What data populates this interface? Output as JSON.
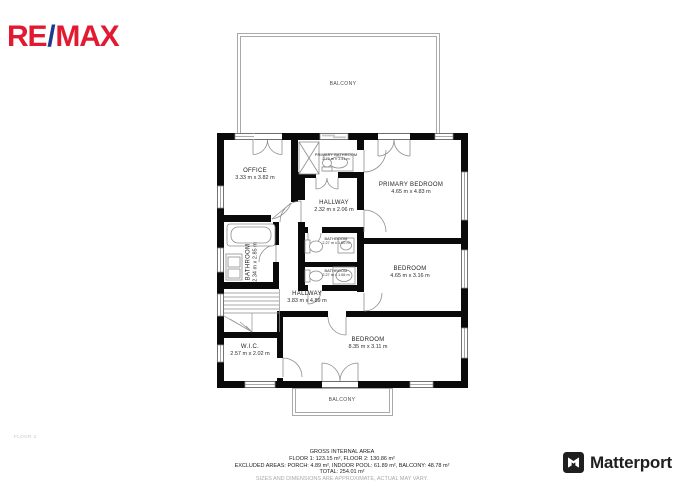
{
  "branding": {
    "remax": {
      "part1": "RE",
      "slash": "/",
      "part2": "MAX",
      "red": "#e11931",
      "blue": "#1d3a8f"
    },
    "matterport": {
      "label": "Matterport",
      "color": "#1e1f1e"
    }
  },
  "floor_label": "FLOOR 2",
  "rooms": {
    "balcony_top": {
      "name": "BALCONY"
    },
    "office": {
      "name": "OFFICE",
      "dims": "3.33 m x 3.82 m"
    },
    "primary_bathroom": {
      "name": "PRIMARY BATHROOM",
      "dims": "2.79 m x 1.41 m"
    },
    "primary_bedroom": {
      "name": "PRIMARY BEDROOM",
      "dims": "4.65 m x 4.83 m"
    },
    "hallway_small": {
      "name": "HALLWAY",
      "dims": "2.32 m x 2.06 m"
    },
    "bathroom_mid_1": {
      "name": "BATHROOM",
      "dims": "2.27 m x 1.50 m"
    },
    "bathroom_mid_2": {
      "name": "BATHROOM",
      "dims": "2.27 m x 1.06 m"
    },
    "bathroom_left": {
      "name": "BATHROOM",
      "dims": "2.34 m x 2.85 m"
    },
    "bedroom_mid": {
      "name": "BEDROOM",
      "dims": "4.65 m x 3.16 m"
    },
    "hallway_main": {
      "name": "HALLWAY",
      "dims": "3.83 m x 4.89 m"
    },
    "wic": {
      "name": "W.I.C.",
      "dims": "2.57 m x 2.02 m"
    },
    "bedroom_bottom": {
      "name": "BEDROOM",
      "dims": "8.35 m x 3.11 m"
    },
    "balcony_bottom": {
      "name": "BALCONY"
    }
  },
  "footer": {
    "title": "GROSS INTERNAL AREA",
    "floors": "FLOOR 1: 123.15 m², FLOOR 2: 130.86 m²",
    "excluded": "EXCLUDED AREAS: PORCH: 4.89 m², INDOOR POOL: 61.89 m², BALCONY: 48.78 m²",
    "total": "TOTAL: 254.01 m²",
    "disclaimer": "SIZES AND DIMENSIONS ARE APPROXIMATE, ACTUAL MAY VARY."
  }
}
